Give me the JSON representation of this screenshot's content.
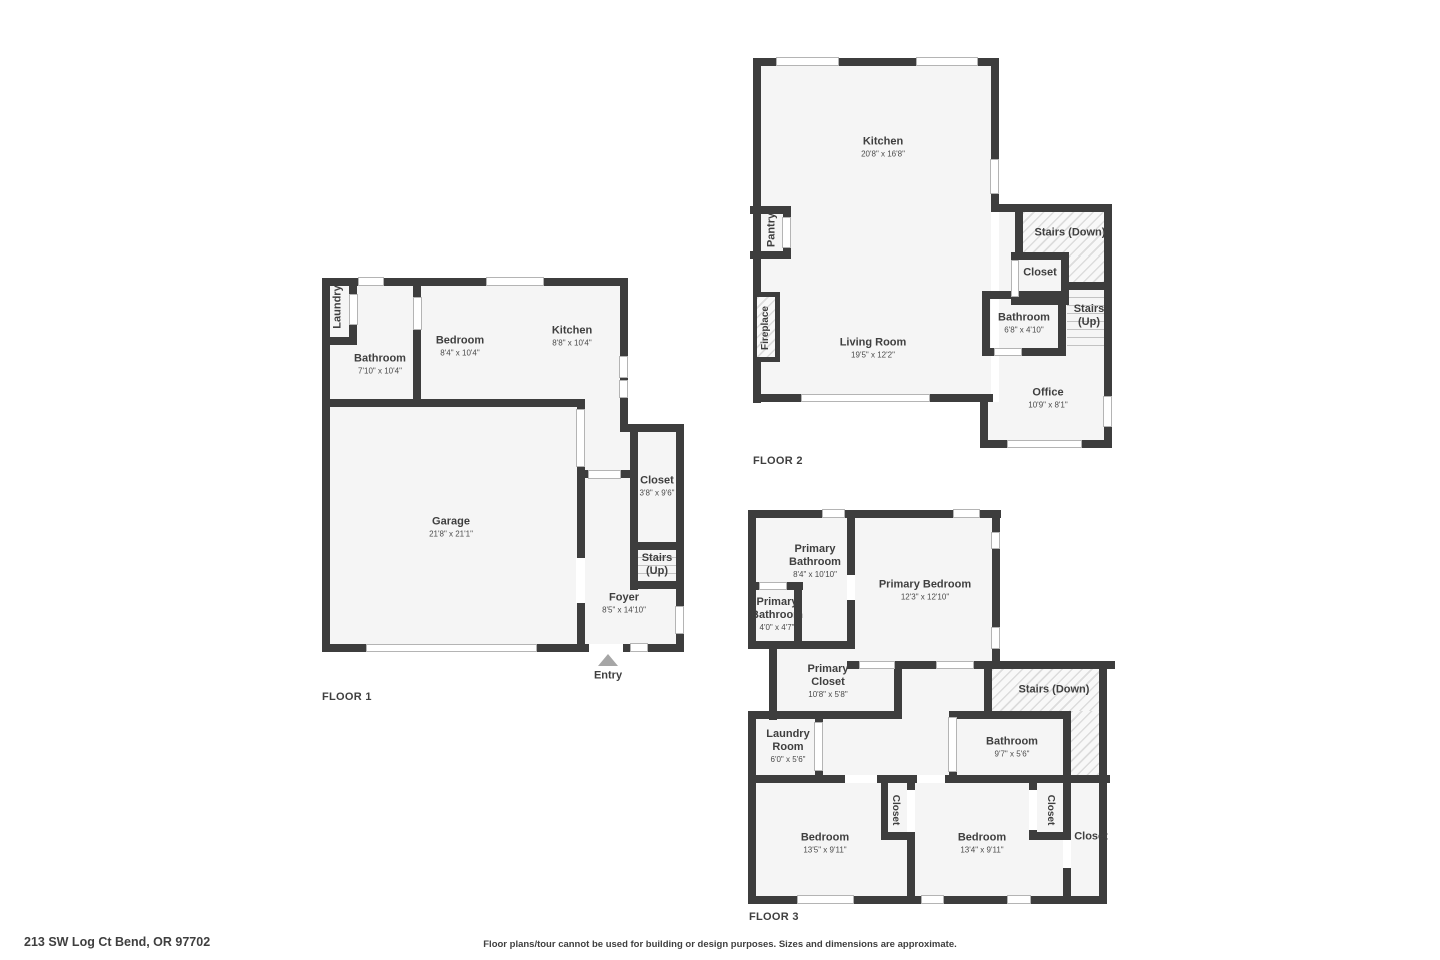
{
  "address": "213 SW Log Ct Bend, OR 97702",
  "disclaimer": "Floor plans/tour cannot be used for building or design purposes. Sizes and dimensions are approximate.",
  "colors": {
    "wall": "#3d3d3d",
    "floor": "#f5f5f5",
    "entry_marker": "#a6a6a6",
    "text": "#3f3f3f"
  },
  "floors": [
    {
      "label": "FLOOR 1",
      "rooms": {
        "laundry": {
          "name": "Laundry"
        },
        "bathroom": {
          "name": "Bathroom",
          "dims": "7'10\" x 10'4\""
        },
        "bedroom": {
          "name": "Bedroom",
          "dims": "8'4\" x 10'4\""
        },
        "kitchen": {
          "name": "Kitchen",
          "dims": "8'8\" x 10'4\""
        },
        "garage": {
          "name": "Garage",
          "dims": "21'8\" x 21'1\""
        },
        "closet": {
          "name": "Closet",
          "dims": "3'8\" x 9'6\""
        },
        "stairs": {
          "name": "Stairs",
          "sub": "(Up)"
        },
        "foyer": {
          "name": "Foyer",
          "dims": "8'5\" x 14'10\""
        },
        "entry": {
          "name": "Entry"
        }
      }
    },
    {
      "label": "FLOOR 2",
      "rooms": {
        "kitchen": {
          "name": "Kitchen",
          "dims": "20'8\" x 16'8\""
        },
        "pantry": {
          "name": "Pantry"
        },
        "fireplace": {
          "name": "Fireplace"
        },
        "living_room": {
          "name": "Living Room",
          "dims": "19'5\" x 12'2\""
        },
        "stairs_down": {
          "name": "Stairs (Down)"
        },
        "closet": {
          "name": "Closet"
        },
        "bathroom": {
          "name": "Bathroom",
          "dims": "6'8\" x 4'10\""
        },
        "stairs_up": {
          "name": "Stairs",
          "sub": "(Up)"
        },
        "office": {
          "name": "Office",
          "dims": "10'9\" x 8'1\""
        }
      }
    },
    {
      "label": "FLOOR 3",
      "rooms": {
        "primary_bathroom": {
          "name": "Primary Bathroom",
          "dims": "8'4\" x 10'10\""
        },
        "primary_bathroom_small": {
          "name": "Primary Bathroom",
          "dims": "4'0\" x 4'7\""
        },
        "primary_bedroom": {
          "name": "Primary Bedroom",
          "dims": "12'3\" x 12'10\""
        },
        "primary_closet": {
          "name": "Primary Closet",
          "dims": "10'8\" x 5'8\""
        },
        "stairs_down": {
          "name": "Stairs (Down)"
        },
        "laundry_room": {
          "name": "Laundry Room",
          "dims": "6'0\" x 5'6\""
        },
        "bathroom": {
          "name": "Bathroom",
          "dims": "9'7\" x 5'6\""
        },
        "bedroom_left": {
          "name": "Bedroom",
          "dims": "13'5\" x 9'11\""
        },
        "bedroom_right": {
          "name": "Bedroom",
          "dims": "13'4\" x 9'11\""
        },
        "closet_mid": {
          "name": "Closet"
        },
        "closet_right": {
          "name": "Closet"
        },
        "closet_far": {
          "name": "Closet"
        }
      }
    }
  ]
}
